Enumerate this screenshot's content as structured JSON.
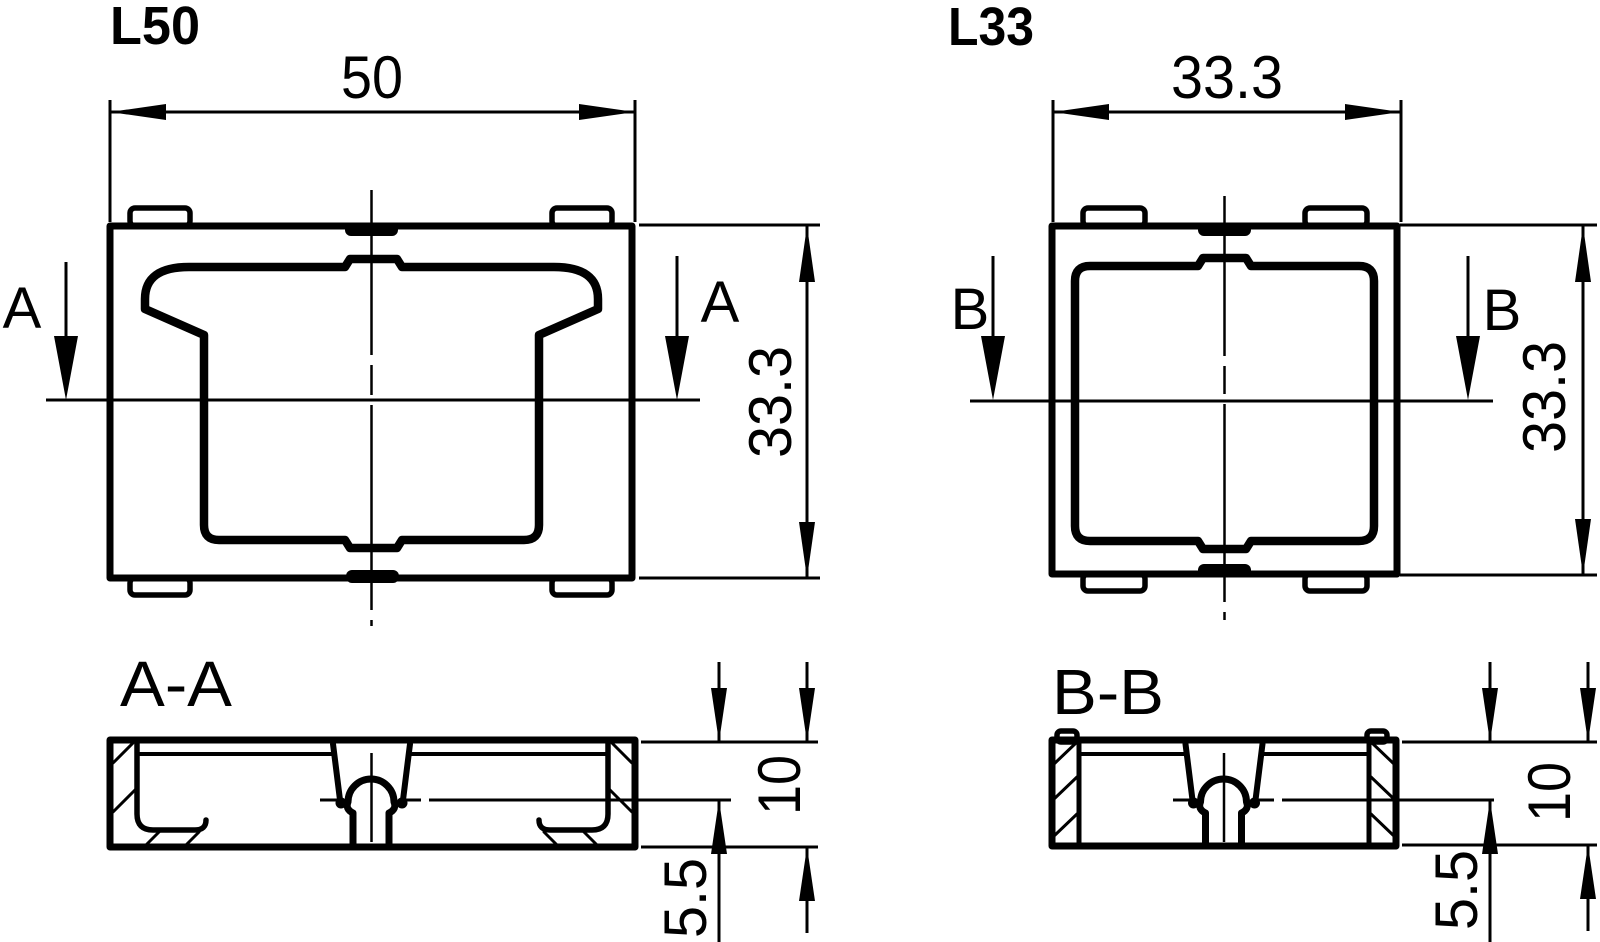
{
  "drawing": {
    "type": "engineering-drawing",
    "colors": {
      "background": "#ffffff",
      "line": "#000000"
    },
    "parts": [
      {
        "title": "L50",
        "top_width": "50",
        "side_height": "33.3",
        "section_letter": "A",
        "section_label": "A-A",
        "section_thickness": "10",
        "section_lip_depth": "5.5"
      },
      {
        "title": "L33",
        "top_width": "33.3",
        "side_height": "33.3",
        "section_letter": "B",
        "section_label": "B-B",
        "section_thickness": "10",
        "section_lip_depth": "5.5"
      }
    ]
  }
}
